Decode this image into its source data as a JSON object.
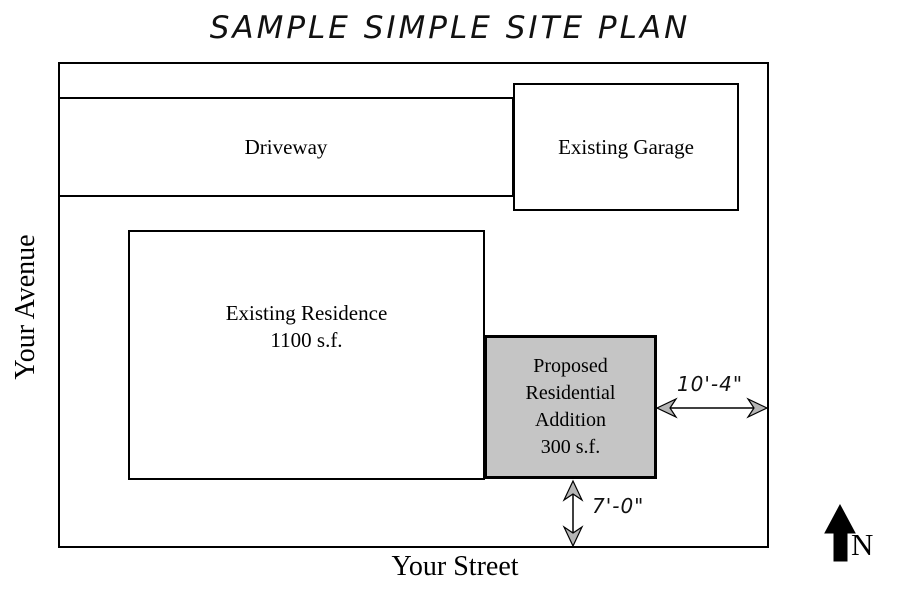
{
  "title": "SAMPLE SIMPLE SITE PLAN",
  "streets": {
    "left": "Your Avenue",
    "bottom": "Your Street"
  },
  "structures": {
    "driveway": {
      "label": "Driveway"
    },
    "garage": {
      "label": "Existing Garage"
    },
    "residence": {
      "lines": [
        "Existing Residence",
        "1100 s.f."
      ]
    },
    "addition": {
      "lines": [
        "Proposed",
        "Residential",
        "Addition",
        "300 s.f."
      ],
      "fill_color": "#c5c5c5"
    }
  },
  "dimensions": {
    "right_setback": "10'-4\"",
    "bottom_setback": "7'-0\""
  },
  "compass": {
    "north_label": "N"
  },
  "colors": {
    "line": "#000000",
    "background": "#ffffff"
  }
}
